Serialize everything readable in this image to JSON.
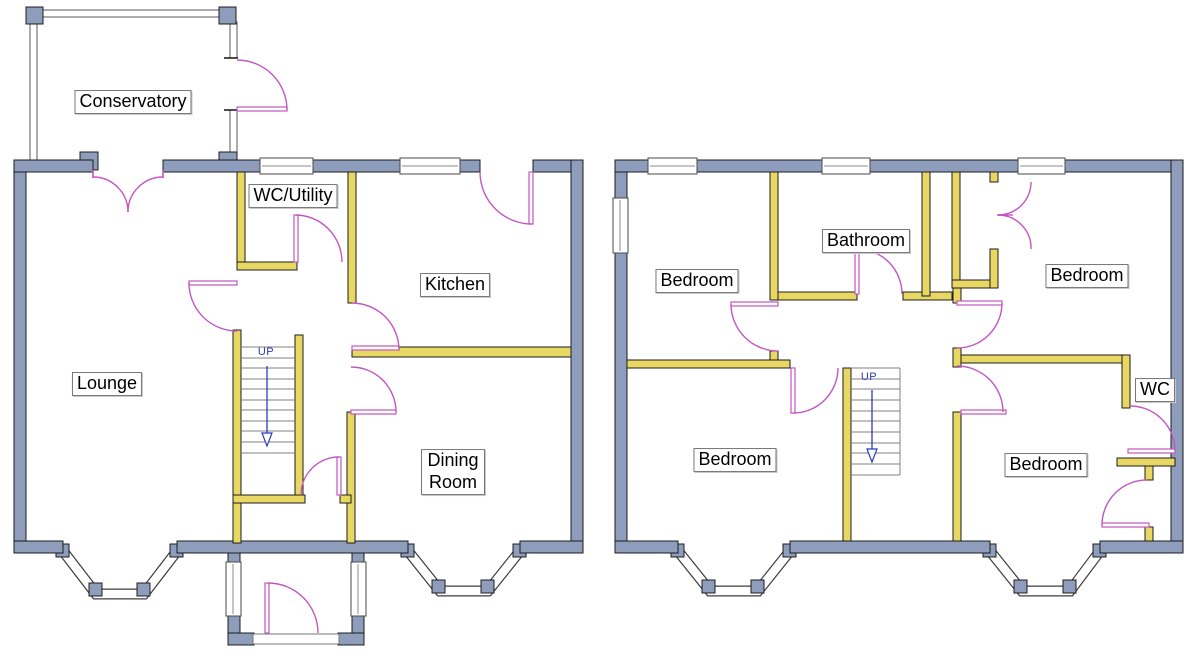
{
  "colors": {
    "wall-exterior": "#8e9dbb",
    "wall-interior": "#e9d763",
    "door": "#c257c2",
    "stair-annotation": "#2b3bbf",
    "label-text": "#000000",
    "label-border": "#777777"
  },
  "floors": {
    "ground": {
      "name": "Ground Floor",
      "rooms": [
        {
          "id": "conservatory",
          "label": "Conservatory"
        },
        {
          "id": "wc-utility",
          "label": "WC/Utility"
        },
        {
          "id": "kitchen",
          "label": "Kitchen"
        },
        {
          "id": "lounge",
          "label": "Lounge"
        },
        {
          "id": "dining-room",
          "label": "Dining Room"
        }
      ],
      "stairs": {
        "label": "UP"
      }
    },
    "first": {
      "name": "First Floor",
      "rooms": [
        {
          "id": "bedroom-front-left",
          "label": "Bedroom"
        },
        {
          "id": "bathroom",
          "label": "Bathroom"
        },
        {
          "id": "bedroom-front-right",
          "label": "Bedroom"
        },
        {
          "id": "bedroom-back-left",
          "label": "Bedroom"
        },
        {
          "id": "bedroom-back-right",
          "label": "Bedroom"
        },
        {
          "id": "wc",
          "label": "WC"
        }
      ],
      "stairs": {
        "label": "UP"
      }
    }
  }
}
